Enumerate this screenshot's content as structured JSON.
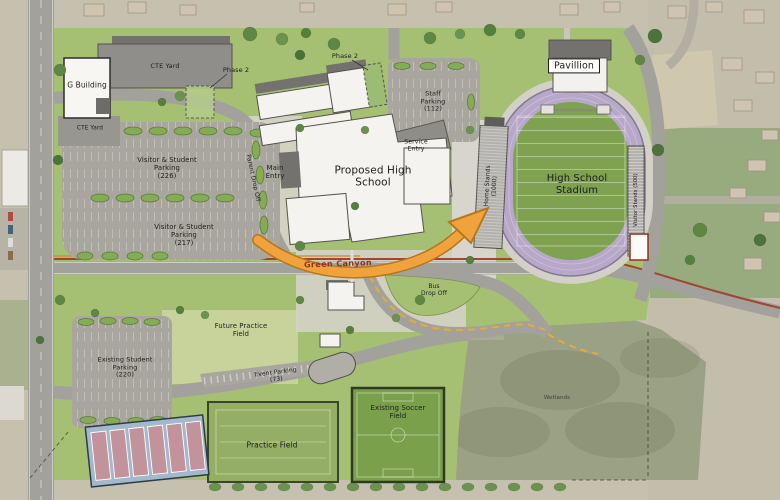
{
  "palette": {
    "grass": "#a6c073",
    "road": "#a3a19c",
    "parking": "#a9a69f",
    "track": "#b7a7c8",
    "fieldgreen": "#7ea24f",
    "arrow": "#f0a33c",
    "arrowedge": "#b5791c",
    "canal": "#a2442f",
    "busdash": "#dfae3a",
    "tennis": "#a3b8cb",
    "court": "#c3939b",
    "bldg": "#f4f3ef",
    "roof": "#74726e",
    "wetland": "#9aa184",
    "ink": "#1d1d1b",
    "roadlabel": "#8e3322"
  },
  "labels": {
    "g_building": "G Building",
    "cte_yard_upper": "CTE Yard",
    "cte_yard_lower": "CTE Yard",
    "phase_2_west": "Phase 2",
    "phase_2_east": "Phase 2",
    "staff_parking": "Staff\nParking\n(112)",
    "service_entry": "Service\nEntry",
    "pavillion": "Pavillion",
    "main_entry": "Main\nEntry",
    "parent_drop_off": "Parent Drop Off",
    "visitor_student_parking_north": "Visitor & Student\nParking\n(226)",
    "visitor_student_parking_south": "Visitor & Student\nParking\n(217)",
    "proposed_high_school": "Proposed High\nSchool",
    "home_stands": "Home Stands\n(1000)",
    "visitor_stands": "Visitor Stands (500)",
    "high_school_stadium": "High School\nStadium",
    "road_name": "Green Canyon",
    "bus_drop_off": "Bus\nDrop Off",
    "future_practice_field": "Future Practice\nField",
    "existing_student_parking": "Existing Student\nParking\n(220)",
    "event_parking": "Event Parking\n(73)",
    "practice_field": "Practice Field",
    "existing_soccer_field": "Existing Soccer\nField",
    "wetlands": "Wetlands"
  }
}
